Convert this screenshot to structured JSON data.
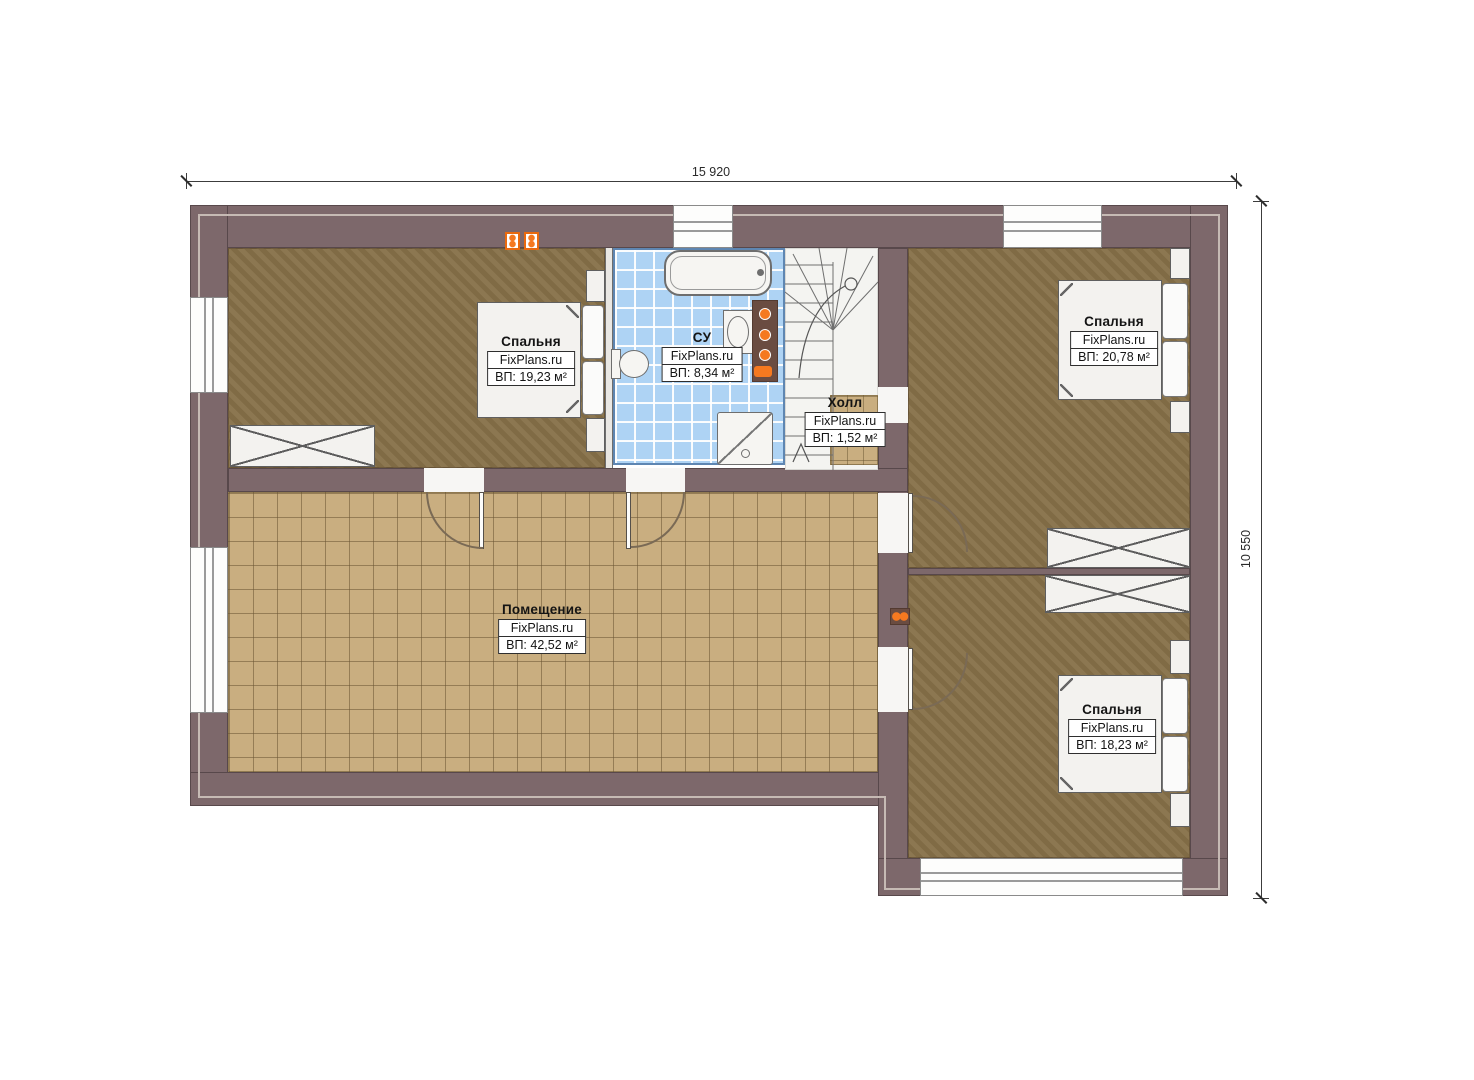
{
  "plan": {
    "width_label": "15 920",
    "height_label": "10 550"
  },
  "rooms": {
    "bedroom_tl": {
      "title": "Спальня",
      "brand": "FixPlans.ru",
      "area": "ВП: 19,23 м²"
    },
    "bathroom": {
      "title": "СУ",
      "brand": "FixPlans.ru",
      "area": "ВП: 8,34 м²"
    },
    "hall": {
      "title": "Холл",
      "brand": "FixPlans.ru",
      "area": "ВП: 1,52 м²"
    },
    "bedroom_tr": {
      "title": "Спальня",
      "brand": "FixPlans.ru",
      "area": "ВП: 20,78 м²"
    },
    "main_room": {
      "title": "Помещение",
      "brand": "FixPlans.ru",
      "area": "ВП: 42,52 м²"
    },
    "bedroom_br": {
      "title": "Спальня",
      "brand": "FixPlans.ru",
      "area": "ВП: 18,23 м²"
    }
  },
  "colors": {
    "wall": "#7d686b",
    "wood_floor": "#877149",
    "tile_floor": "#c9ae80",
    "bath_tile": "#aed3f4",
    "accent_orange": "#f57920",
    "towel_warmer": "#6a4c41"
  }
}
